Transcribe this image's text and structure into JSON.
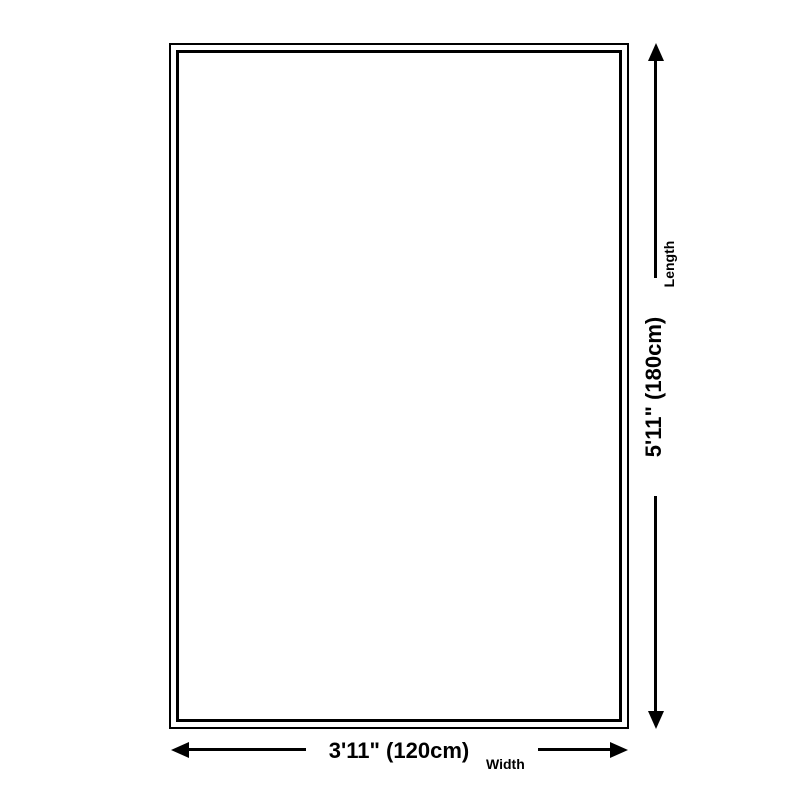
{
  "diagram": {
    "kind": "product-dimensions",
    "width_dimension": {
      "value": "3'11\" (120cm)",
      "caption": "Width"
    },
    "length_dimension": {
      "value": "5'11\" (180cm)",
      "caption": "Length"
    },
    "colors": {
      "line": "#000000",
      "background": "#ffffff"
    }
  }
}
